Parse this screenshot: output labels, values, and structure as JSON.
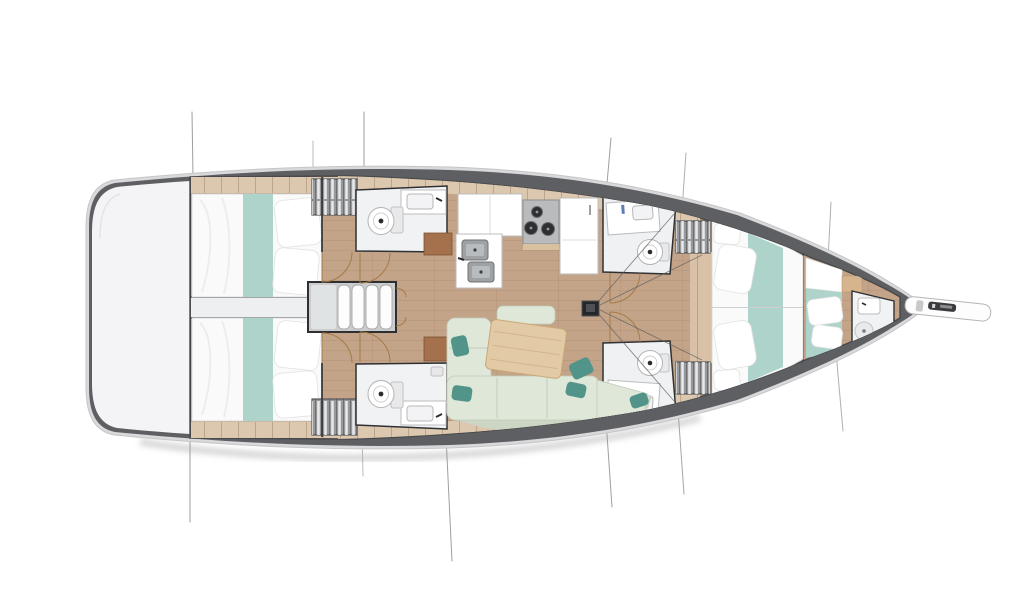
{
  "page": {
    "background": "#ffffff"
  },
  "diagram": {
    "type": "sailing-yacht-interior-floor-plan-top-view",
    "orientation": "bow-right-stern-left",
    "counts": {
      "double_berths": 4,
      "heads": 5,
      "hanging_lockers": 4,
      "companionway_steps": 4,
      "stove_burners": 3,
      "galley_sinks": 2
    },
    "features": [
      "stern-swim-platform",
      "aft-cabin-port",
      "aft-cabin-starboard",
      "engine-compartment",
      "companionway-stairs",
      "head-port-mid",
      "head-starboard-mid",
      "galley-with-stove-and-sinks",
      "salon-sofa-with-table",
      "mast",
      "head-port-forward",
      "head-starboard-forward",
      "owner-cabin-v-berth",
      "bow-cabin-berth",
      "bow-head",
      "bowsprit-with-windlass",
      "rigging-lines"
    ],
    "colors": {
      "bg": "#ffffff",
      "hull_light": "#d9d9db",
      "hull_outline": "#c6c6c8",
      "hull_dark": "#5e5f62",
      "deck": "#f4f4f6",
      "floor": "#c3a488",
      "plank": "#dcc7af",
      "wall": "#3a3b3d",
      "bed": "#fafafb",
      "teal": "#aed3ca",
      "teal_dark": "#53948a",
      "sage": "#dee7d8",
      "sage_dark": "#c2cdbb",
      "table": "#e3caa6",
      "brown": "#a4714c",
      "locker": "#97999b",
      "engine": "#edeff0",
      "rig": "#8e8e90",
      "door": "#a57a46",
      "fixture": "#bcbcbe",
      "stair_frame": "#2e2f31"
    }
  }
}
